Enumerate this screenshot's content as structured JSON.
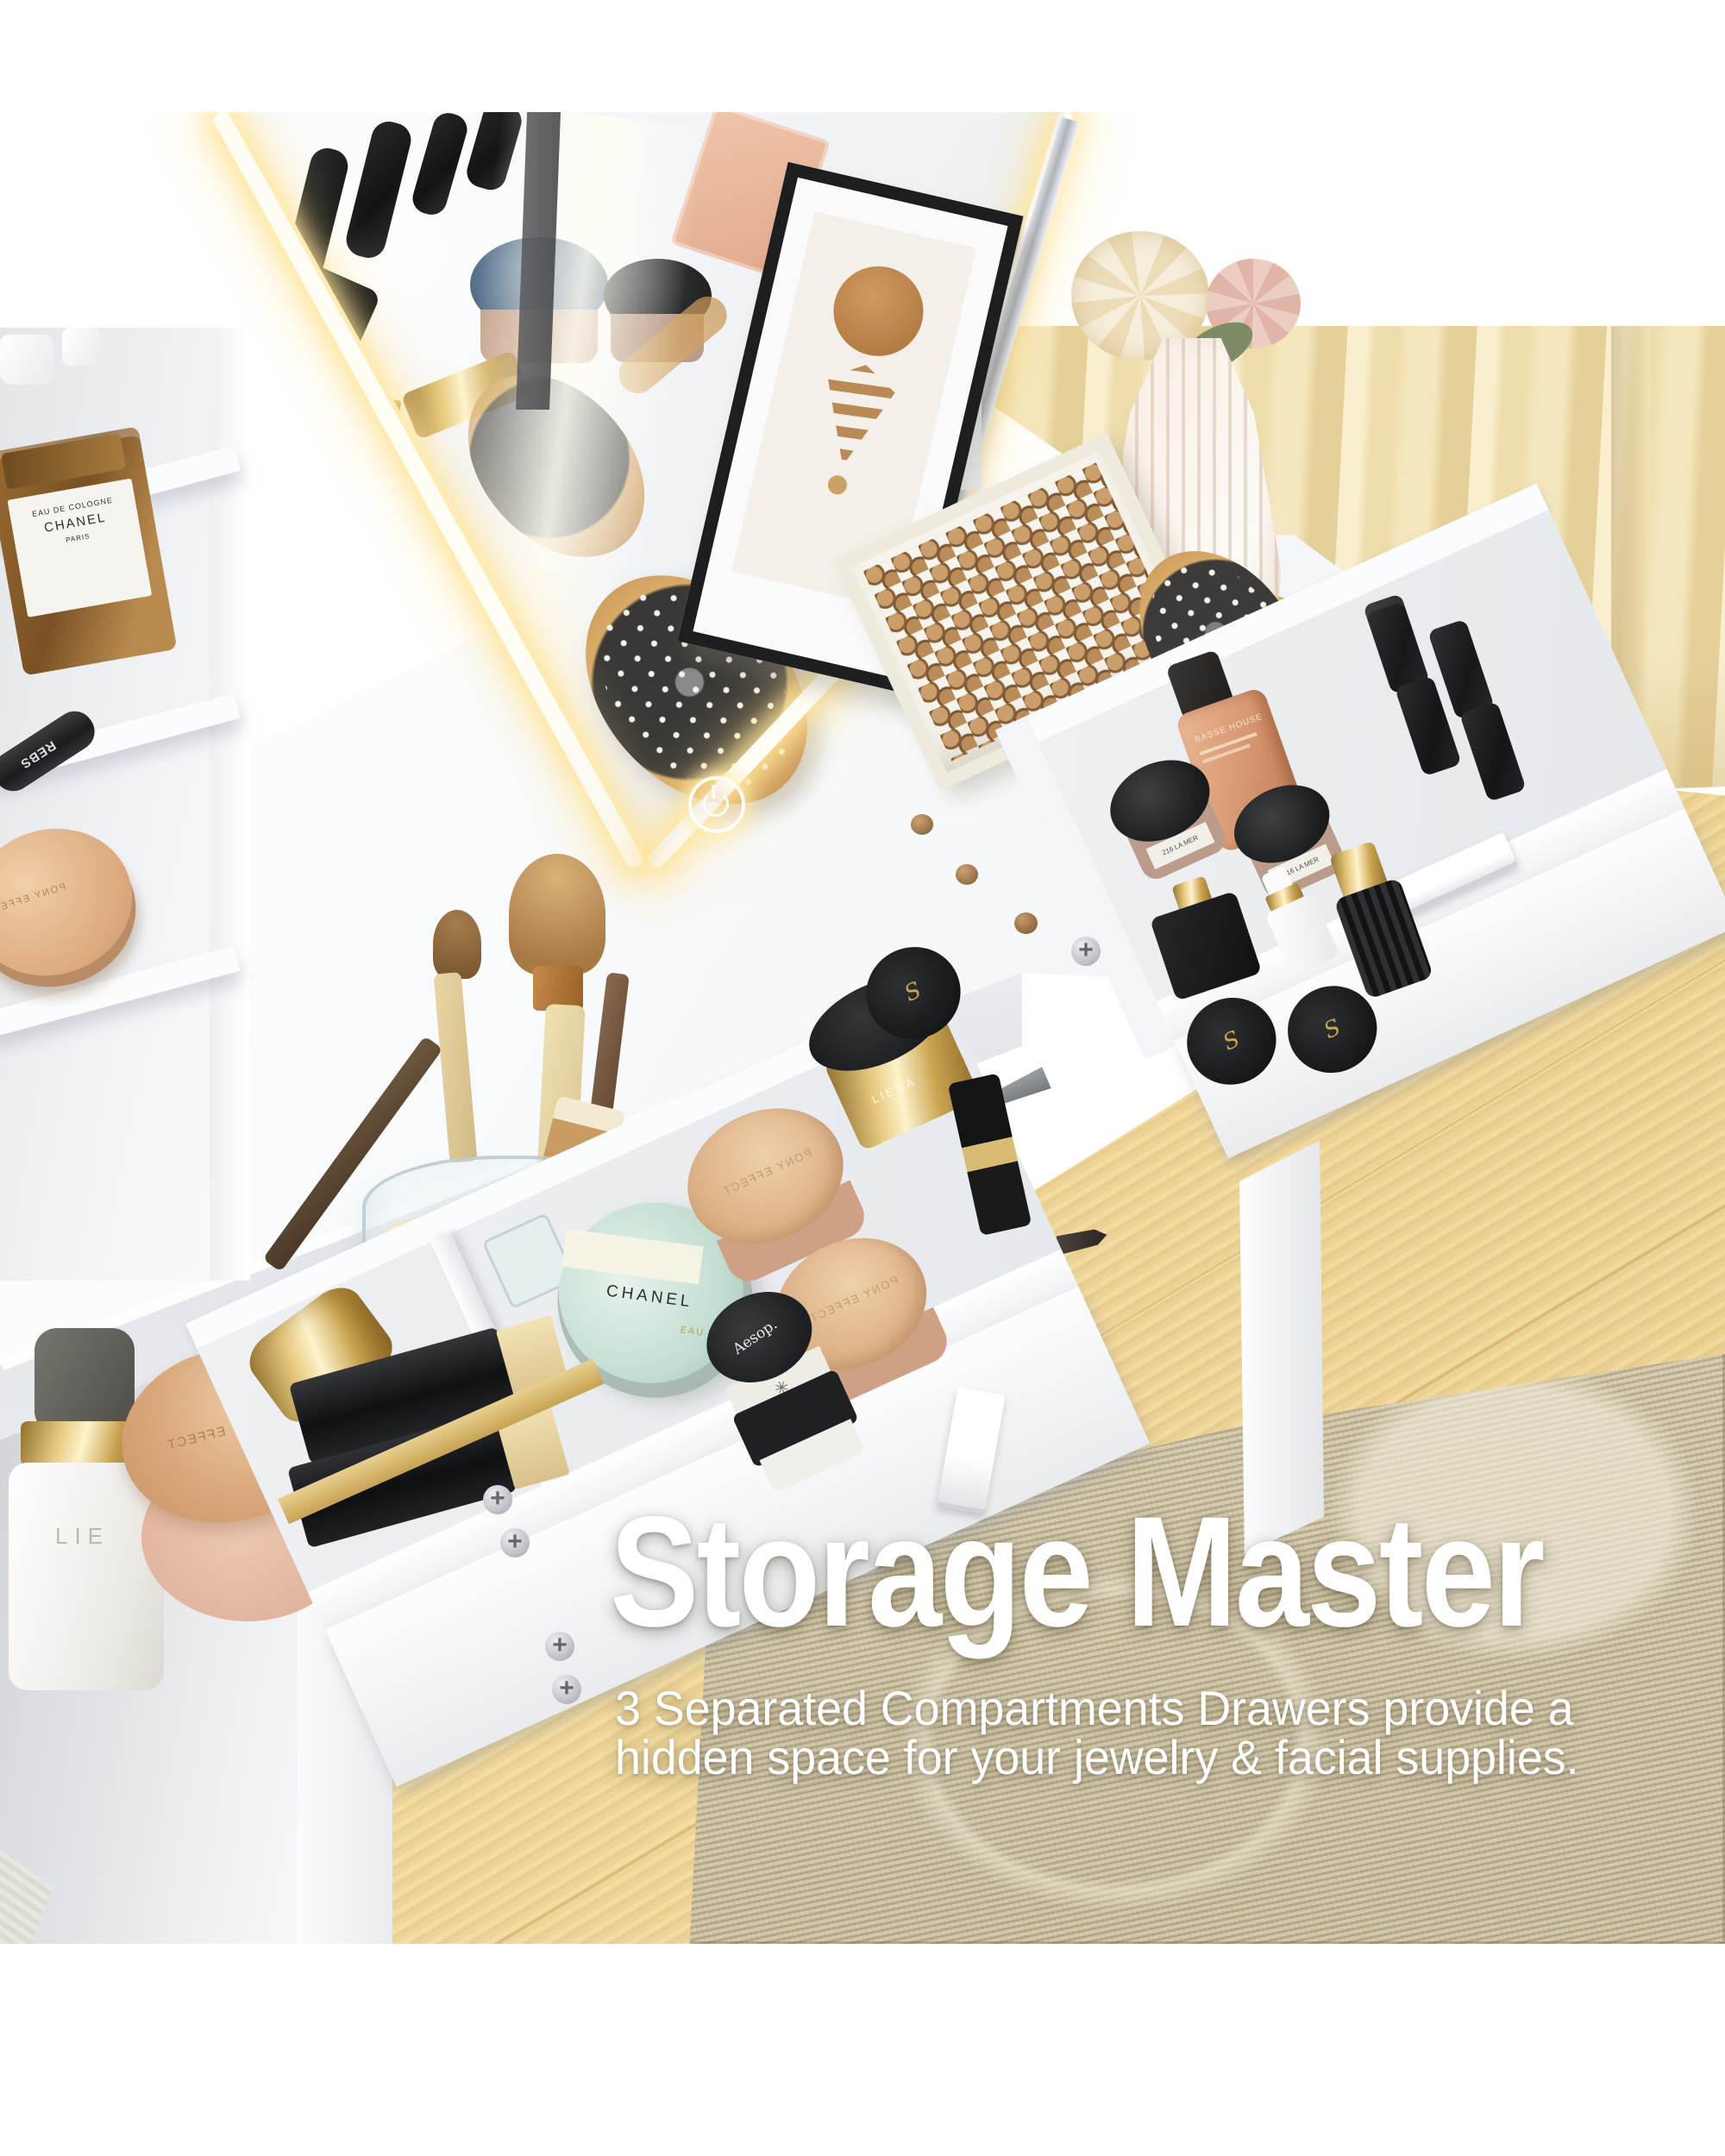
{
  "overlay": {
    "heading": "Storage Master",
    "subtitle_line1": "3 Separated Compartments Drawers provide a",
    "subtitle_line2": "hidden space for your jewelry & facial supplies.",
    "text_color": "#ffffff"
  },
  "palette": {
    "background": "#ffffff",
    "furniture_white": "#f7f8fa",
    "drawer_interior": "#e9ebef",
    "curtain_cream": "#f1e1b8",
    "wood_floor": "#f1da9e",
    "wood_grain": "#d3a967",
    "rug_beige": "#cdc0a2",
    "led_warm_white": "#fff6d9",
    "chrome": "#c7cacf",
    "gold": "#d9b45e",
    "rose_gold": "#e0b18c",
    "taupe": "#b99a89",
    "peach_foundation": "#dba183",
    "glass_green": "#cfe2d8",
    "black_cosmetic": "#1a1b1d"
  },
  "scene": {
    "furniture": "white vanity dressing table with LED hollywood mirror, side open shelves, hutch, two pulled-out drawers with separated compartments, white bar handles, wood legs room with cream curtain, maple wood floor and beige patterned rug",
    "mirror": {
      "type": "LED lighted mirror, tilted",
      "touch_button": "power touch control on glass"
    },
    "shelf_items": [
      {
        "name": "cologne-bottle",
        "brand_line1": "EAU DE COLOGNE",
        "brand_line2": "CHANEL",
        "brand_line3": "PARIS"
      },
      {
        "name": "black-tube",
        "brand": "REBS"
      },
      {
        "name": "rose-gold-powder-compact",
        "brand": "PONY EFFECT"
      },
      {
        "name": "small-white-pots"
      }
    ],
    "desktop_items": [
      {
        "name": "dropper-serum-bottle",
        "brand": "LIE"
      },
      {
        "name": "powder-compact-stack",
        "brand": "PONY EFFECT"
      },
      {
        "name": "glass-brush-cup",
        "contents": "makeup brushes, brow pencils, fragrance box"
      },
      {
        "name": "flat-brush",
        "number": "05"
      },
      {
        "name": "brow-brush-long"
      },
      {
        "name": "brow-pencil-tan",
        "brand": "ICL"
      },
      {
        "name": "cream-jar",
        "brand": "LIERAC"
      },
      {
        "name": "dropper-bottle-white",
        "brand": "NUO"
      },
      {
        "name": "mini-bottle-black-cap"
      },
      {
        "name": "gold-cap"
      },
      {
        "name": "paddle-hairbrush-on-mirror",
        "brand": "DETNY"
      },
      {
        "name": "paddle-hairbrush-on-desk",
        "brand": "DETNY"
      },
      {
        "name": "bead-tray",
        "contents": "wooden beads"
      },
      {
        "name": "fluted-vase-with-flowers"
      },
      {
        "name": "framed-art-print"
      }
    ],
    "top_drawer_items": [
      {
        "name": "foundation-bottle",
        "brand": "BASSE HOUSE"
      },
      {
        "name": "cream-jar-black-lid-1",
        "label": "216 LA MER"
      },
      {
        "name": "cream-jar-black-lid-2",
        "label": "216 LA MER"
      },
      {
        "name": "black-lipsticks",
        "count": 4
      },
      {
        "name": "black-square-serum-gold-dropper"
      },
      {
        "name": "white-dropper-bottle"
      },
      {
        "name": "black-fluted-bottle-gold-cap"
      },
      {
        "name": "black-round-jars-gold-s",
        "count": 2,
        "logo": "S"
      }
    ],
    "bottom_drawer_items": [
      {
        "name": "gold-cylinder-cap"
      },
      {
        "name": "black-perfume-bottles-gold-base",
        "count": 2
      },
      {
        "name": "round-perfume",
        "brand": "CHANEL",
        "line": "EAU VIVE"
      },
      {
        "name": "rose-gold-compacts",
        "brand": "PONY EFFECT",
        "count": 2
      },
      {
        "name": "gold-jar-black-lid",
        "brand": "LIERA"
      },
      {
        "name": "black-jar-gold-s",
        "logo": "S"
      },
      {
        "name": "black-gold-lipstick"
      },
      {
        "name": "jar-stack",
        "brand": "Aesop."
      }
    ]
  }
}
